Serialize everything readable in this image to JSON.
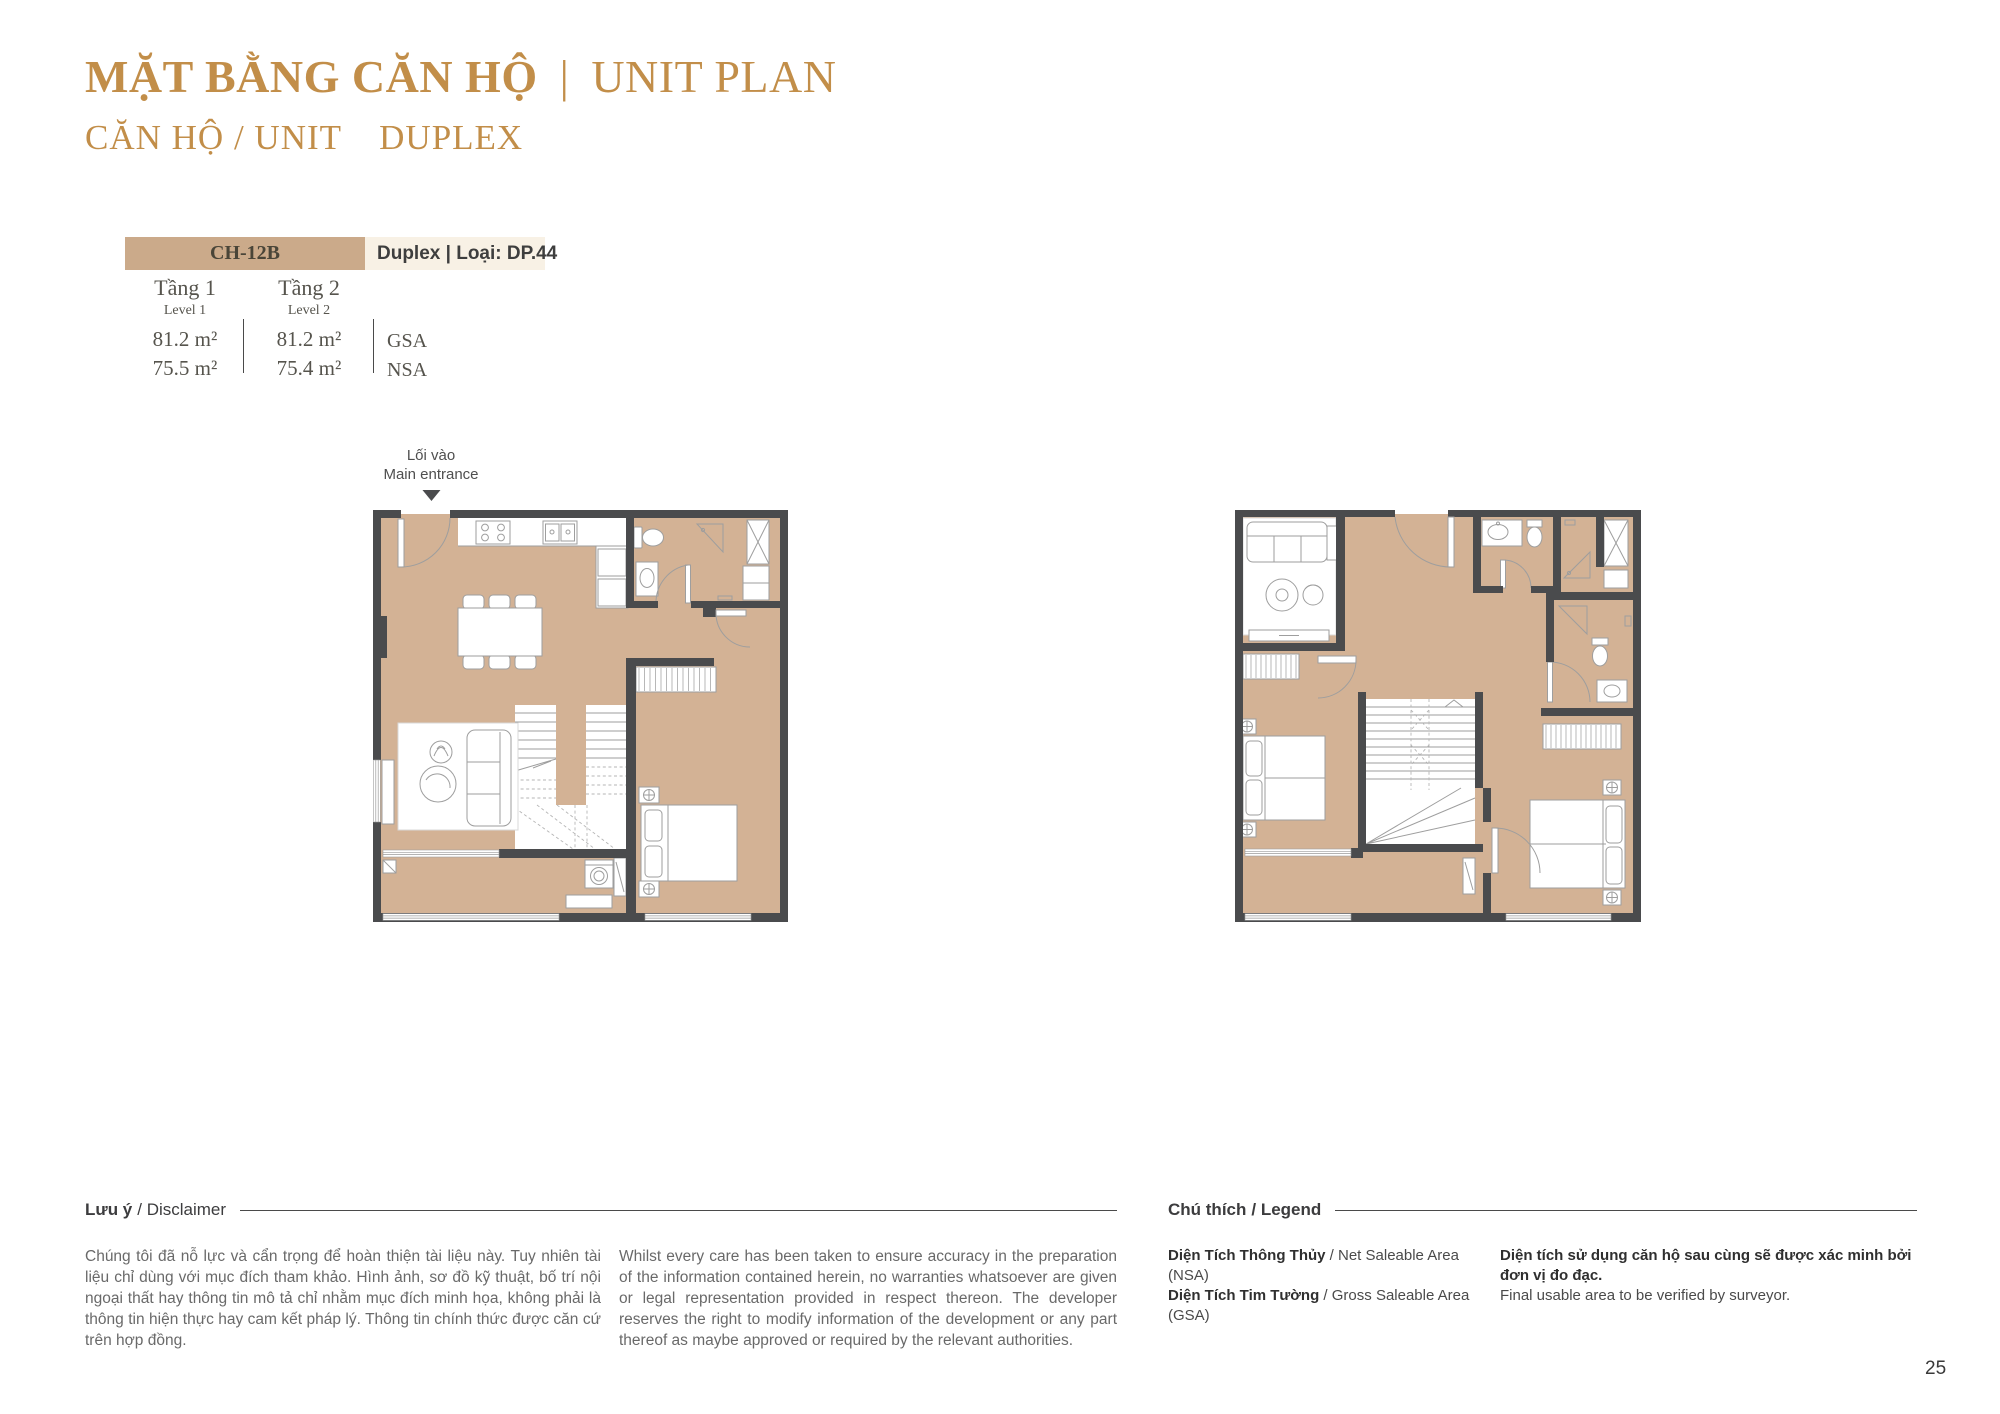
{
  "page": {
    "number": "25"
  },
  "colors": {
    "gold": "#C28E49",
    "table_tan": "#CBAA8A",
    "table_cream": "#F8F1E5",
    "floor": "#D3B295",
    "wall": "#4A4B4D",
    "text_dark": "#3C3C3E",
    "text_table": "#56544D",
    "text_body": "#696969",
    "rule": "#4A4A4A"
  },
  "header": {
    "title_vi": "MẶT BẰNG CĂN HỘ",
    "title_sep": "|",
    "title_en": "UNIT PLAN",
    "subtitle": "CĂN HỘ / UNIT",
    "unit_type": "DUPLEX"
  },
  "unit_info": {
    "code": "CH-12B",
    "type_label": "Duplex | Loại: DP.44",
    "levels": [
      {
        "name_vi": "Tầng 1",
        "name_en": "Level 1",
        "gsa": "81.2 m²",
        "nsa": "75.5 m²"
      },
      {
        "name_vi": "Tầng 2",
        "name_en": "Level 2",
        "gsa": "81.2 m²",
        "nsa": "75.4 m²"
      }
    ],
    "gsa_label": "GSA",
    "nsa_label": "NSA"
  },
  "entrance": {
    "vi": "Lối vào",
    "en": "Main entrance"
  },
  "disclaimer": {
    "heading_vi": "Lưu ý",
    "heading_rest": "/ Disclaimer",
    "text_vi": "Chúng tôi đã nỗ lực và cẩn trọng để hoàn thiện tài liệu này. Tuy nhiên tài liệu chỉ dùng với mục đích tham khảo. Hình ảnh, sơ đồ kỹ thuật, bố trí nội ngoại thất hay thông tin mô tả chỉ nhằm mục đích minh họa, không phải là thông tin hiện thực hay cam kết pháp lý. Thông tin chính thức được căn cứ trên hợp đồng.",
    "text_en": "Whilst every care has been taken to ensure accuracy in the preparation of the information contained herein, no warranties whatsoever are given or legal representation provided in respect thereon. The developer reserves the right to modify information of the development or any part thereof as maybe approved or required by the relevant authorities."
  },
  "legend": {
    "heading_vi": "Chú thích",
    "heading_rest": "/ Legend",
    "items": [
      {
        "vi": "Diện Tích Thông Thủy",
        "en": " / Net Saleable Area (NSA)"
      },
      {
        "vi": "Diện Tích Tim Tường",
        "en": " / Gross Saleable Area (GSA)"
      }
    ],
    "note_vi": "Diện tích sử dụng căn hộ sau cùng sẽ được xác minh bởi đơn vị đo đạc.",
    "note_en": "Final usable area to be verified by surveyor."
  }
}
